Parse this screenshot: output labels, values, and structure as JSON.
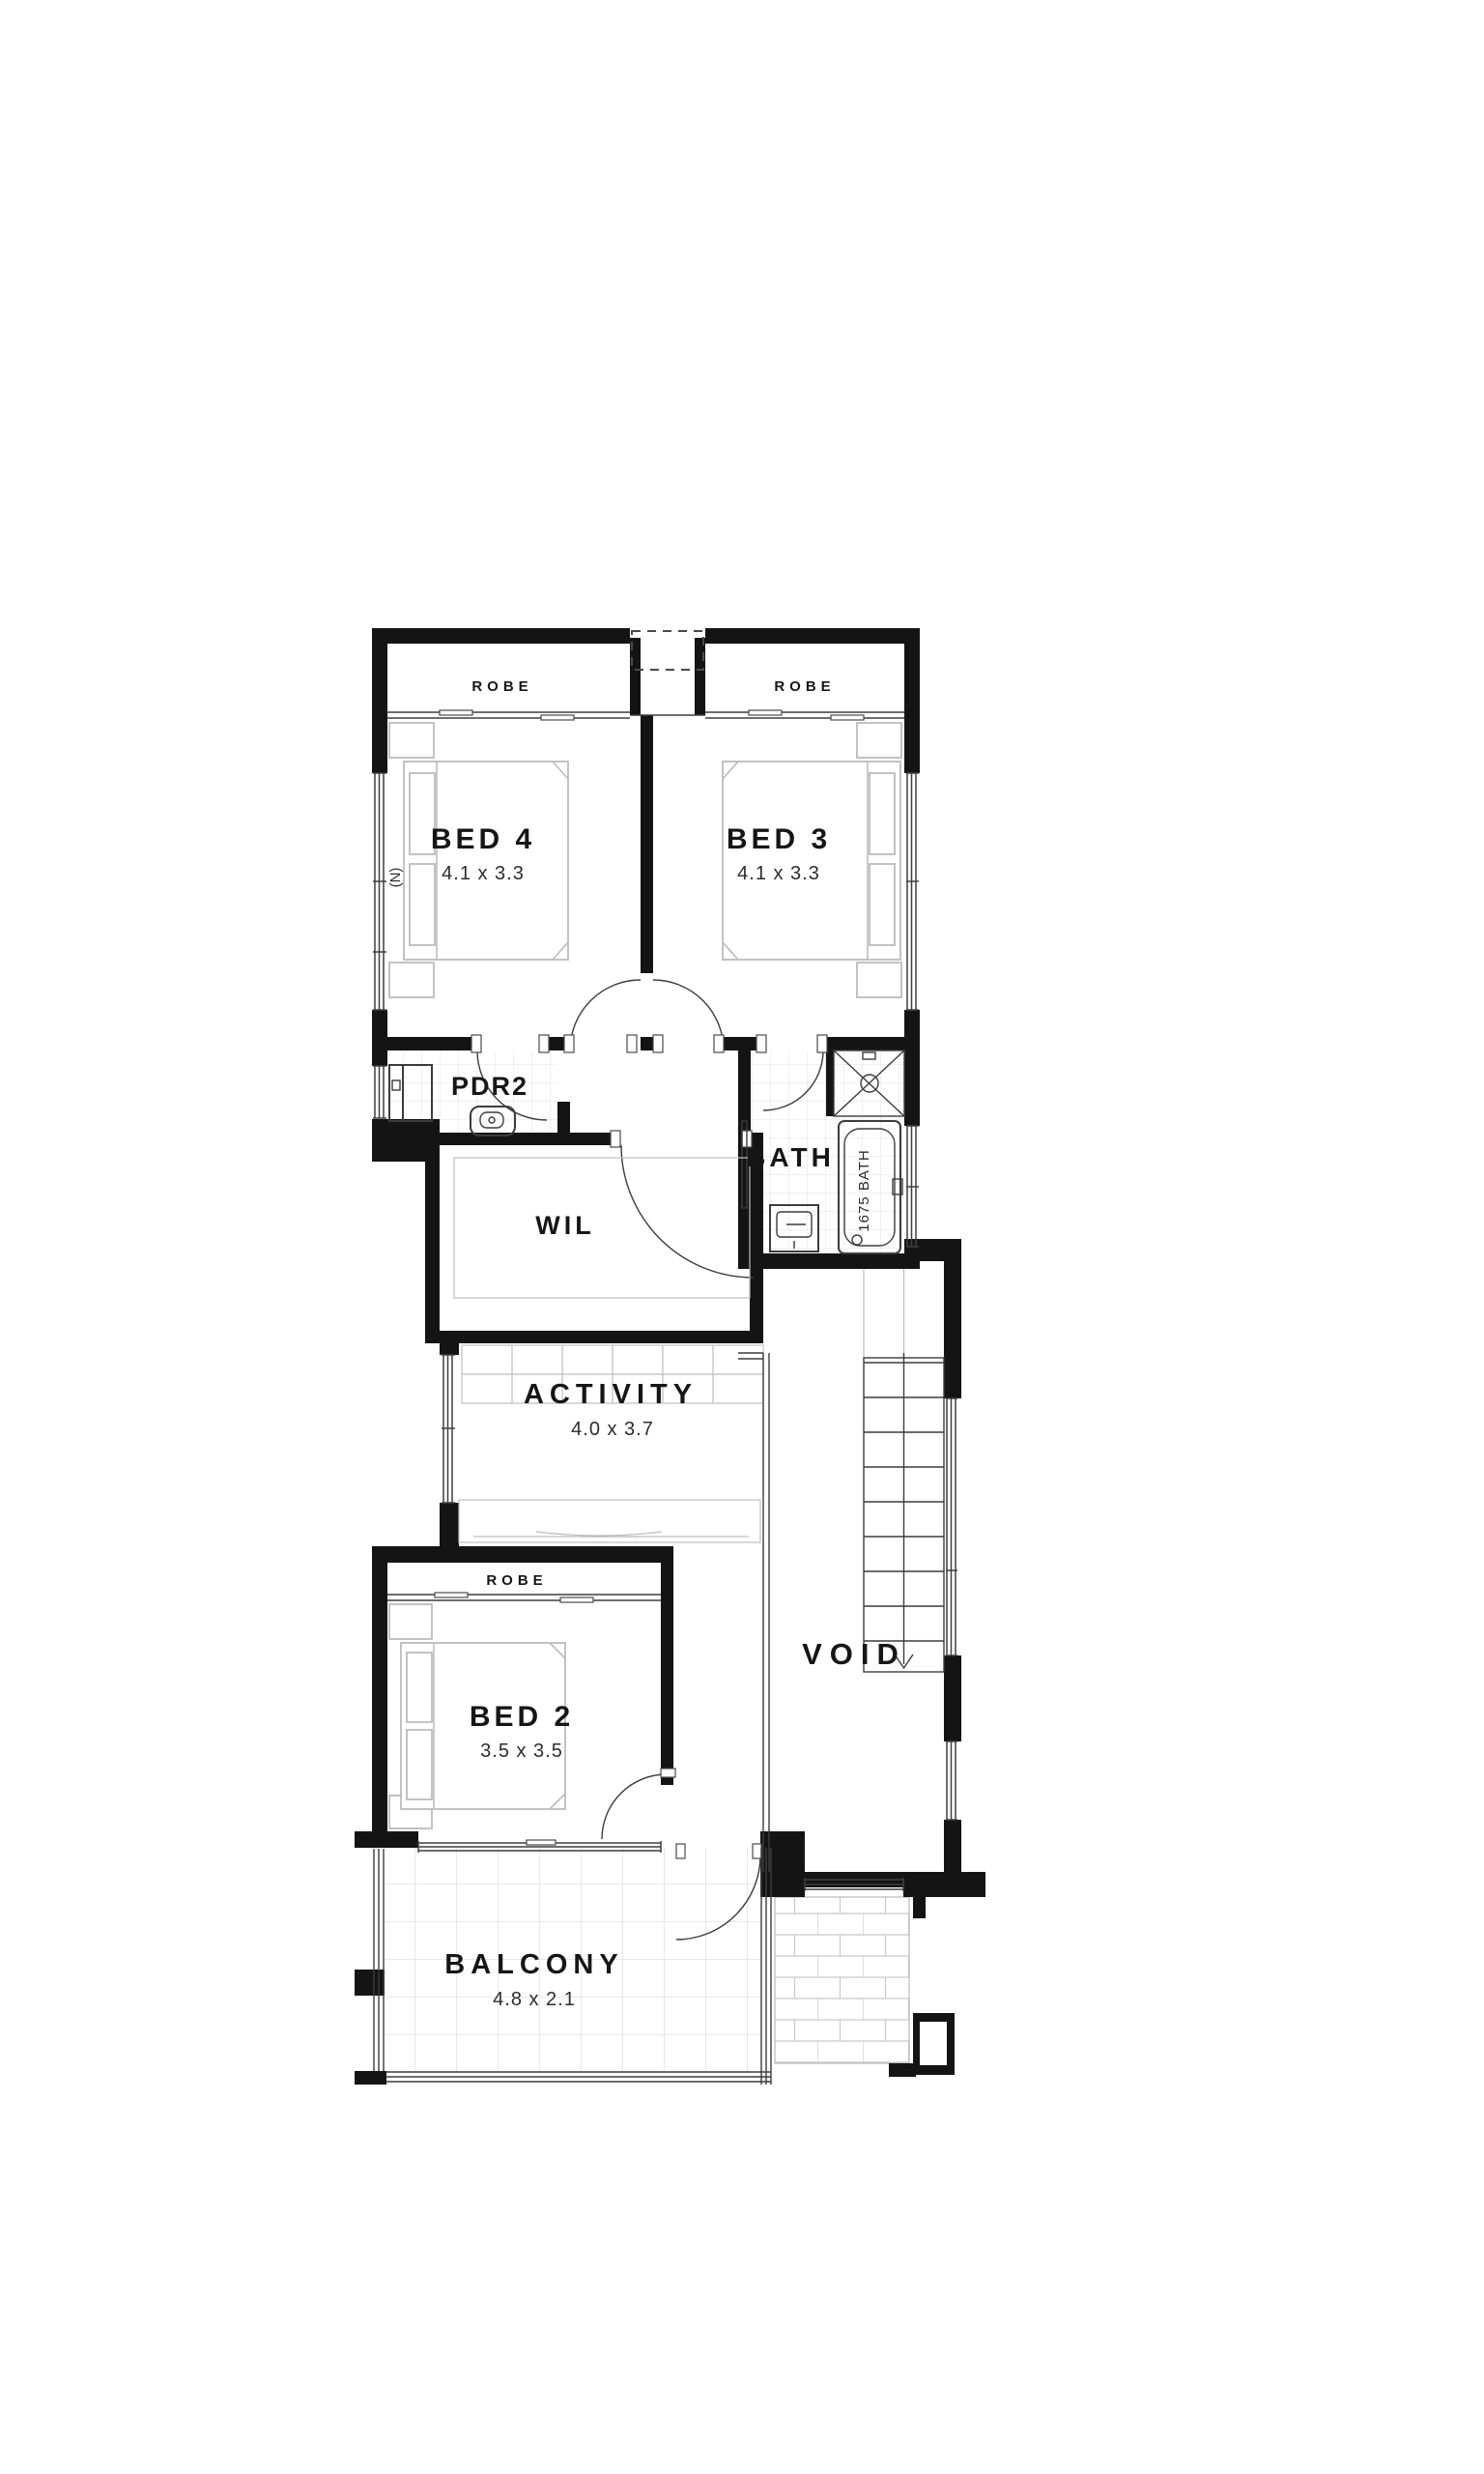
{
  "document": {
    "background": "#ffffff"
  },
  "plan": {
    "rooms": {
      "bed4": {
        "label": "BED 4",
        "dims": "4.1 x 3.3"
      },
      "bed3": {
        "label": "BED 3",
        "dims": "4.1 x 3.3"
      },
      "bed2": {
        "label": "BED 2",
        "dims": "3.5 x 3.5"
      },
      "activity": {
        "label": "ACTIVITY",
        "dims": "4.0 x 3.7"
      },
      "balcony": {
        "label": "BALCONY",
        "dims": "4.8 x 2.1"
      },
      "bath": {
        "label": "BATH"
      },
      "pdr2": {
        "label": "PDR2"
      },
      "wil": {
        "label": "WIL"
      },
      "void": {
        "label": "VOID"
      },
      "robe4": {
        "label": "ROBE"
      },
      "robe3": {
        "label": "ROBE"
      },
      "robe2": {
        "label": "ROBE"
      }
    },
    "annotations": {
      "tub": "1675 BATH",
      "north": "(N)"
    },
    "colors": {
      "wall": "#141414",
      "line": "#3c3c3c",
      "furniture": "#bcbcbc",
      "tile": "#dedede",
      "paving": "#cccccc"
    }
  }
}
